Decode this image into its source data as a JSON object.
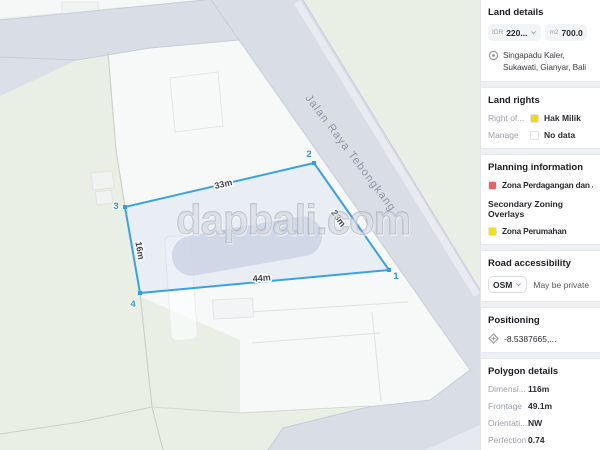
{
  "watermark": "dapbali.com",
  "map": {
    "road_label": "Jalan Raya Tebongkang",
    "polygon": {
      "vertex_labels": [
        "1",
        "2",
        "3",
        "4"
      ],
      "edge_labels": {
        "top": "33m",
        "right": "23m",
        "bottom": "44m",
        "left": "16m"
      }
    }
  },
  "sidebar": {
    "land_details": {
      "title": "Land details",
      "price_chip": {
        "prefix": "IDR",
        "value": "220..."
      },
      "area_chip": {
        "prefix": "m2",
        "value": "700.0"
      },
      "location": "Singapadu Kaler, Sukawati, Gianyar, Bali"
    },
    "land_rights": {
      "title": "Land rights",
      "rows": [
        {
          "label": "Right of...",
          "value": "Hak Milik",
          "swatch": "#f6d60d"
        },
        {
          "label": "Manage",
          "value": "No data",
          "swatch": ""
        }
      ]
    },
    "planning": {
      "title": "Planning information",
      "primary_zone": {
        "label": "Zona Perdagangan dan Jasa",
        "swatch": "#ec6161"
      },
      "overlays_title": "Secondary Zoning Overlays",
      "overlay_zone": {
        "label": "Zona Perumahan",
        "swatch": "#f5df0e"
      }
    },
    "road_accessibility": {
      "title": "Road accessibility",
      "source": "OSM",
      "note": "May be private"
    },
    "positioning": {
      "title": "Positioning",
      "coordinates": "-8.5387665,..."
    },
    "polygon_details": {
      "title": "Polygon details",
      "rows": [
        {
          "label": "Dimensi...",
          "value": "116m"
        },
        {
          "label": "Frontage",
          "value": "49.1m"
        },
        {
          "label": "Orientati...",
          "value": "NW"
        },
        {
          "label": "Perfection",
          "value": "0.74"
        }
      ]
    }
  }
}
